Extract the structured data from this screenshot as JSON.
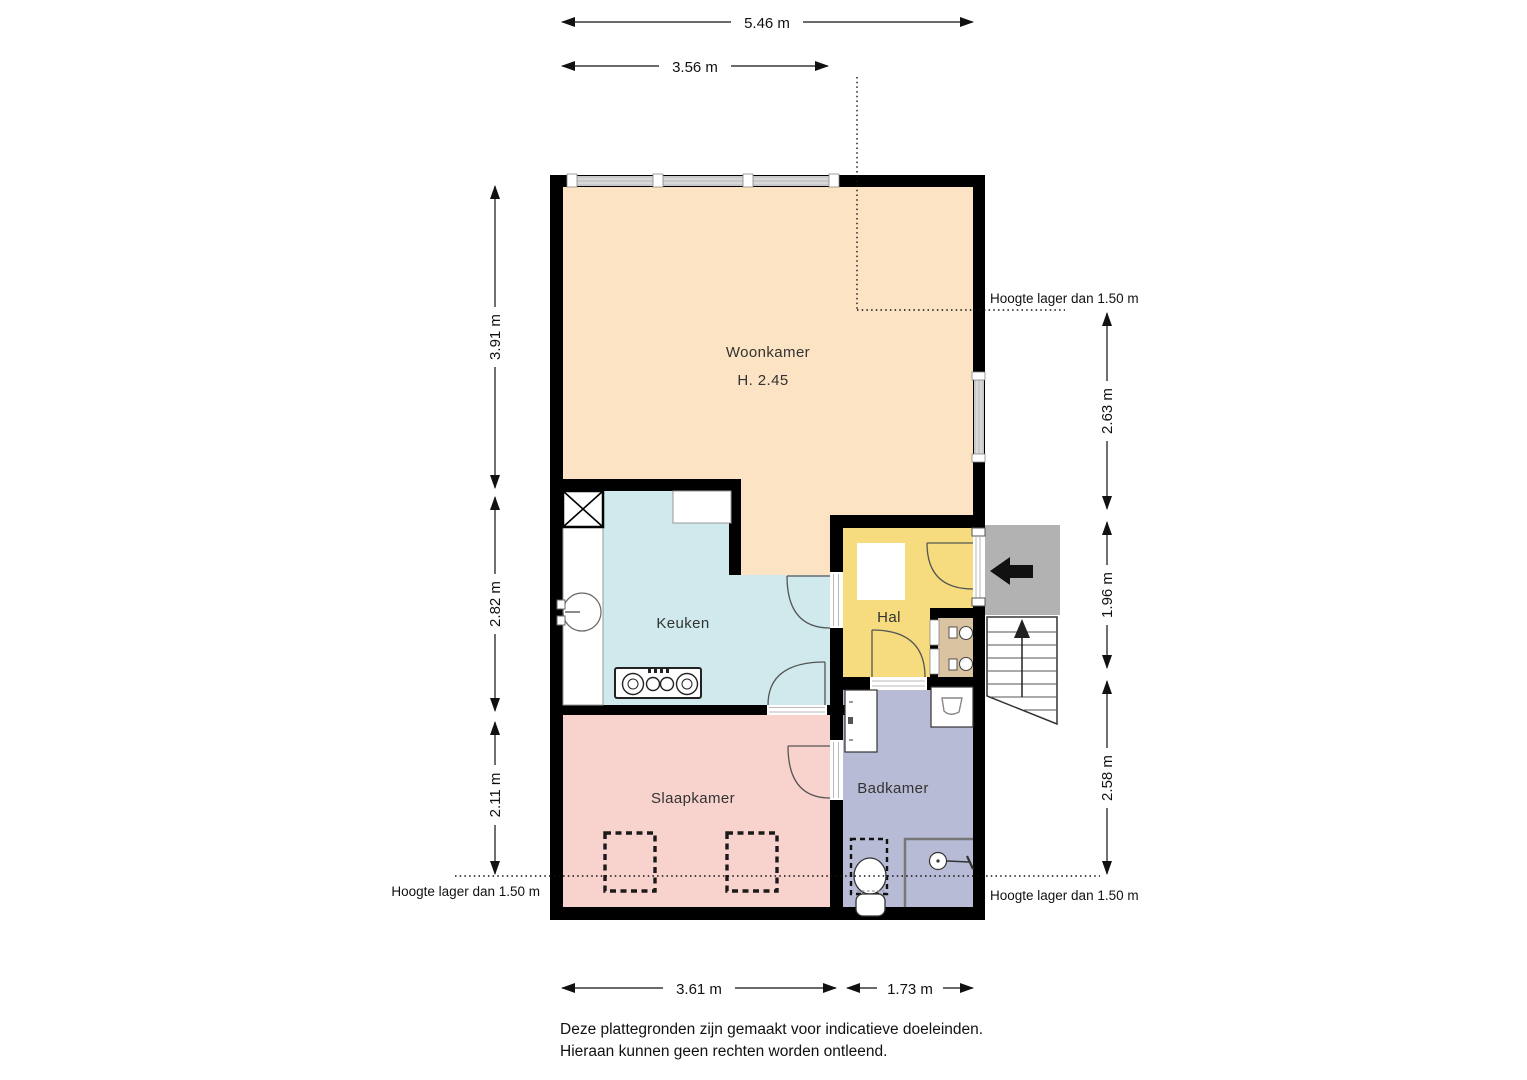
{
  "floor_plan": {
    "rooms": {
      "woonkamer": {
        "label": "Woonkamer",
        "height_note": "H. 2.45"
      },
      "keuken": {
        "label": "Keuken"
      },
      "hal": {
        "label": "Hal"
      },
      "slaapkamer": {
        "label": "Slaapkamer"
      },
      "badkamer": {
        "label": "Badkamer"
      }
    },
    "dims": {
      "top_total": "5.46 m",
      "top_partial": "3.56 m",
      "left_top": "3.91 m",
      "left_mid": "2.82 m",
      "left_bottom": "2.11 m",
      "right_top": "2.63 m",
      "right_mid": "1.96 m",
      "right_bottom": "2.58 m",
      "bottom_left": "3.61 m",
      "bottom_right": "1.73 m"
    },
    "notes": {
      "top_right": "Hoogte lager dan 1.50 m",
      "bottom_left": "Hoogte lager dan 1.50 m",
      "bottom_right": "Hoogte lager dan 1.50 m"
    }
  },
  "footer": {
    "line1": "Deze plattegronden zijn gemaakt voor indicatieve doeleinden.",
    "line2": "Hieraan kunnen geen rechten worden ontleend."
  },
  "colors": {
    "woonkamer": "#fce3c3",
    "keuken": "#cfe9ed",
    "hal": "#f6dc7e",
    "slaapkamer": "#f8d2cd",
    "badkamer": "#b8bbd5",
    "meterkast": "#d9c3a0",
    "entrance": "#b2b2b2",
    "wall": "#000000",
    "window": "#c9c9c9"
  }
}
